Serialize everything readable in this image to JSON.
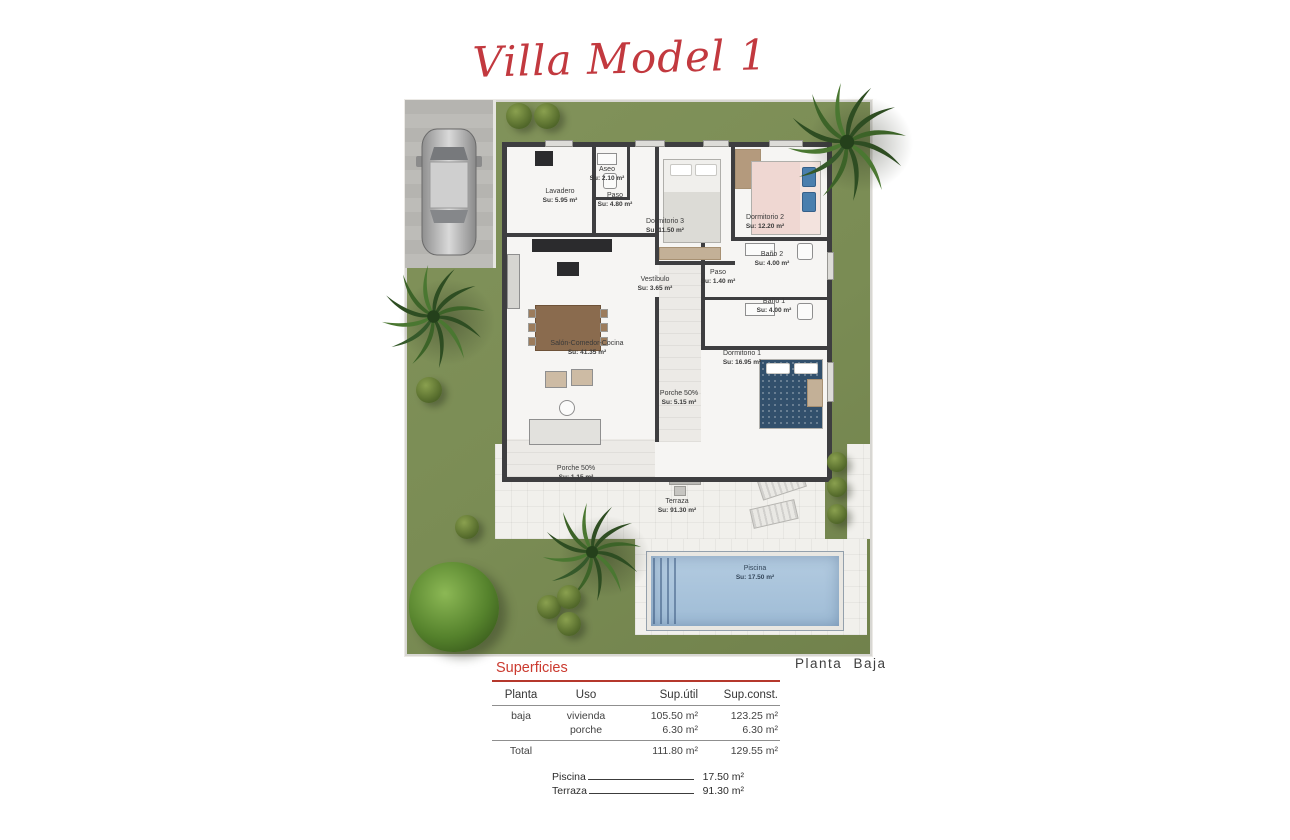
{
  "title": "Villa Model 1",
  "plan_label": "Planta Baja",
  "rooms": [
    {
      "name": "Lavadero",
      "su": "Su: 5.95 m²"
    },
    {
      "name": "Aseo",
      "su": "Su: 2.10 m²"
    },
    {
      "name": "Paso",
      "su": "Su: 4.80 m²"
    },
    {
      "name": "Dormitorio 3",
      "su": "Su: 11.50 m²"
    },
    {
      "name": "Dormitorio 2",
      "su": "Su: 12.20 m²"
    },
    {
      "name": "Baño 2",
      "su": "Su: 4.00 m²"
    },
    {
      "name": "Paso",
      "su": "Su: 1.40 m²"
    },
    {
      "name": "Baño 1",
      "su": "Su: 4.00 m²"
    },
    {
      "name": "Vestíbulo",
      "su": "Su: 3.65 m²"
    },
    {
      "name": "Salón-Comedor-Cocina",
      "su": "Su: 41.35 m²"
    },
    {
      "name": "Dormitorio 1",
      "su": "Su: 16.95 m²"
    },
    {
      "name": "Porche 50%",
      "su": "Su: 5.15 m²"
    },
    {
      "name": "Porche 50%",
      "su": "Su: 1.15 m²"
    },
    {
      "name": "Terraza",
      "su": "Su: 91.30 m²"
    },
    {
      "name": "Piscina",
      "su": "Su: 17.50 m²"
    }
  ],
  "superficies": {
    "title": "Superficies",
    "headers": {
      "planta": "Planta",
      "uso": "Uso",
      "sup_util": "Sup.útil",
      "sup_const": "Sup.const."
    },
    "rows": [
      {
        "planta": "baja",
        "uso": "vivienda",
        "sup_util": "105.50 m²",
        "sup_const": "123.25 m²"
      },
      {
        "planta": "",
        "uso": "porche",
        "sup_util": "6.30 m²",
        "sup_const": "6.30 m²"
      }
    ],
    "total": {
      "label": "Total",
      "sup_util": "111.80 m²",
      "sup_const": "129.55 m²"
    }
  },
  "extras": [
    {
      "label": "Piscina",
      "value": "17.50 m²"
    },
    {
      "label": "Terraza",
      "value": "91.30 m²"
    }
  ],
  "colors": {
    "accent_red": "#c2393f",
    "grass_green": "#7a8c54",
    "wall_dark": "#3e3e40",
    "pool_blue": "#a9c4dc",
    "terrace_white": "#f1f0ec",
    "concrete_gray": "#b7b6b2"
  }
}
